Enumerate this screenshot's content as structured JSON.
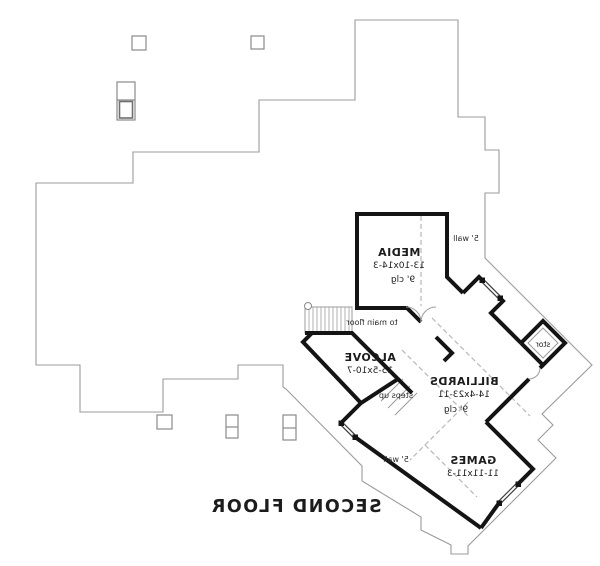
{
  "plan": {
    "title": "SECOND FLOOR",
    "rooms": {
      "media": {
        "name": "MEDIA",
        "dims": "13-10x14-3",
        "ceiling": "9' clg"
      },
      "alcove": {
        "name": "ALCOVE",
        "dims": "15-5x10-7"
      },
      "billiards": {
        "name": "BILLIARDS",
        "dims": "14-4x23-11",
        "ceiling": "9' clg"
      },
      "games": {
        "name": "GAMES",
        "dims": "11-11x11-3"
      },
      "storage": {
        "name": "stor"
      }
    },
    "annotations": {
      "to_main_floor": "to main floor",
      "steps_up": "steps up",
      "wall_note": "5' wall"
    },
    "colors": {
      "wall": "#141414",
      "outline": "#9b9b9b",
      "dashed": "#b8b8b8",
      "text": "#1c1c1c",
      "background": "#ffffff"
    }
  }
}
